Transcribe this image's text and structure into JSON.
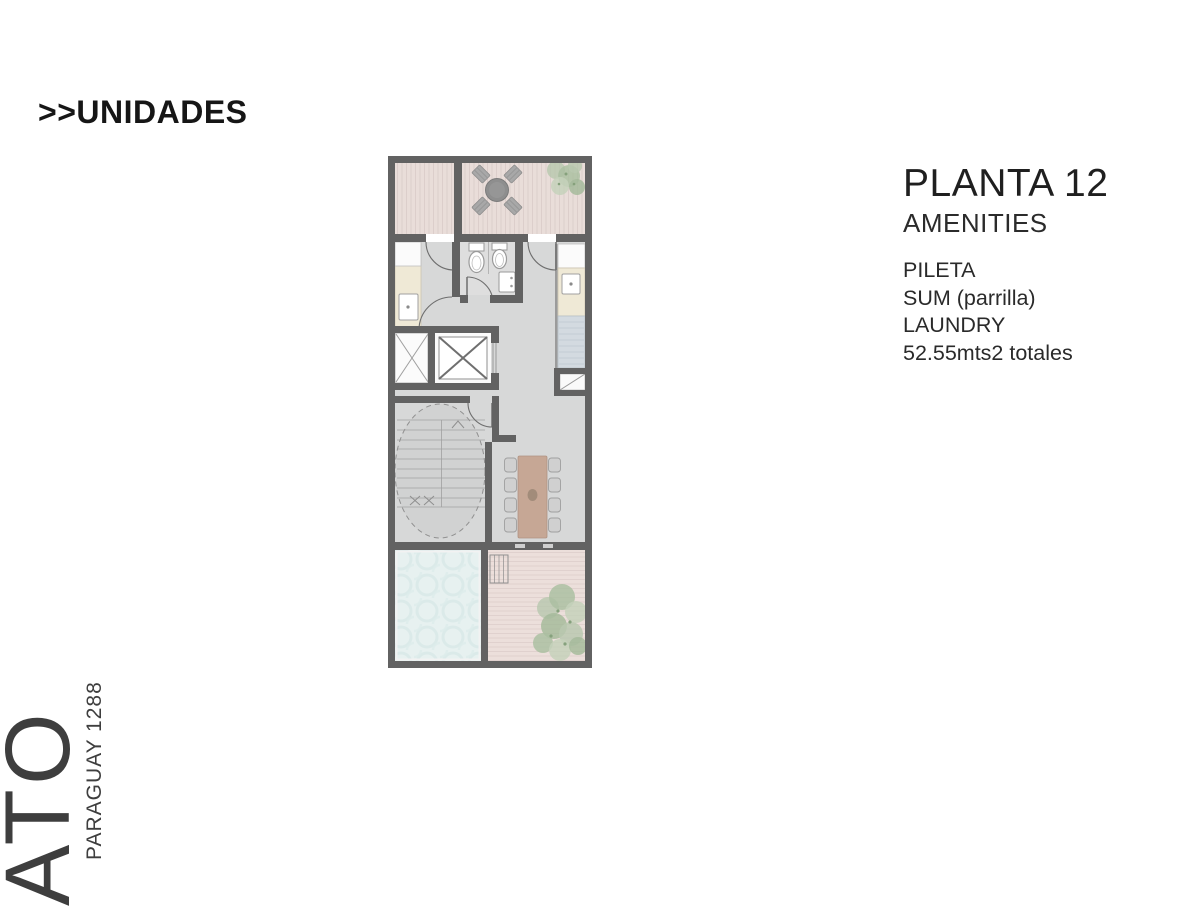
{
  "header": {
    "title": ">>UNIDADES"
  },
  "panel": {
    "title": "PLANTA 12",
    "subtitle": "AMENITIES",
    "amenities": [
      "PILETA",
      "SUM (parrilla)",
      "LAUNDRY"
    ],
    "area": "52.55mts2 totales"
  },
  "brand": {
    "logo": "ATO",
    "address": "PARAGUAY 1288"
  },
  "floor_plan": {
    "palette": {
      "wall": "#626262",
      "interior_floor": "#d7d8d8",
      "terrace_deck": "#e9ddd9",
      "pool_water": "#e7f1f0",
      "counter": "#efe9d6",
      "appliance": "#d3dae0",
      "table_wood": "#c6a795",
      "plant_green": "#a6bd9c",
      "text": "#1f1f1f"
    },
    "features": [
      "terrace-deck",
      "outdoor-dining-set",
      "plant",
      "laundry-room",
      "bathroom",
      "toilet",
      "sink",
      "kitchen-counter",
      "stove",
      "elevator",
      "service-shaft",
      "stairs",
      "dining-table",
      "swimming-pool",
      "lounge-chair",
      "deck-terrace"
    ]
  }
}
